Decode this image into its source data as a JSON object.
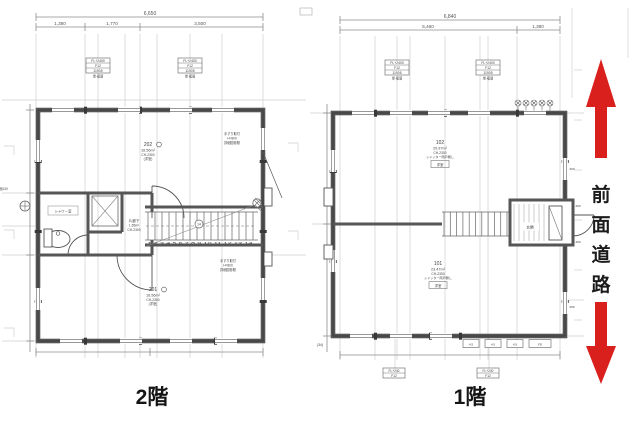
{
  "page": {
    "background": "#ffffff",
    "line_color": "#565656",
    "grid_color": "#cfcfcf",
    "accent_red": "#d9201c"
  },
  "floor2": {
    "caption": "2階",
    "dim_total": "6,650",
    "dim_segs": [
      "1,380",
      "1,770",
      "3,500"
    ],
    "tag1": {
      "r1": "FL+2400",
      "r2": "F12",
      "r3": "11905",
      "sub": "単·複層"
    },
    "tag2": {
      "r1": "FL+2400",
      "r2": "F12",
      "r3": "11905",
      "sub": "単·複層"
    },
    "room202": {
      "id": "202",
      "area": "16.56m²",
      "ch": "CH-2300",
      "note": "(洋室)"
    },
    "room201": {
      "id": "201",
      "area": "16.56m²",
      "ch": "CH-2300",
      "note": "(洋室)"
    },
    "corridor": {
      "name": "片廊下",
      "area": "1.65m²",
      "ch": "CH-2300"
    },
    "shower": "シャワー室",
    "stair_no": "14",
    "stair_nums": "1 2 3 4 5 6 7 8 9 10 11 12 13 14",
    "note_a": [
      "手すり取付",
      "H=800",
      "詳細図参照"
    ],
    "note_b": [
      "手すり取付",
      "H=800",
      "詳細図参照"
    ],
    "bench_note": "踏面130"
  },
  "floor1": {
    "caption": "1階",
    "dim_total": "6,840",
    "dim_segs": [
      "5,460",
      "1,380"
    ],
    "tag1": {
      "r1": "FL+2400",
      "r2": "F12",
      "r3": "11905",
      "sub": "単·複層"
    },
    "tag2": {
      "r1": "FL+2400",
      "r2": "F12",
      "r3": "11905",
      "sub": "単·複層"
    },
    "tag_b1": {
      "r1": "FL+240",
      "r2": "F12"
    },
    "tag_b2": {
      "r1": "FL+240",
      "r2": "F12"
    },
    "room102": {
      "id": "102",
      "area": "20.97m²",
      "ch": "CH-2300",
      "note": "シャッター雨戸無し",
      "tag": "洋室"
    },
    "room101": {
      "id": "101",
      "area": "23.47m²",
      "ch": "CH-2300",
      "note": "シャッター雨戸無し",
      "tag": "洋室"
    },
    "entry": "玄関",
    "vents": [
      "4.5",
      "4.5",
      "4.5",
      "FD"
    ],
    "side_dims": [
      "300",
      "300",
      "300",
      "300"
    ],
    "grid_ref": "(34)"
  },
  "road": {
    "chars": [
      "前",
      "面",
      "道",
      "路"
    ],
    "arrow_color": "#d9201c"
  }
}
